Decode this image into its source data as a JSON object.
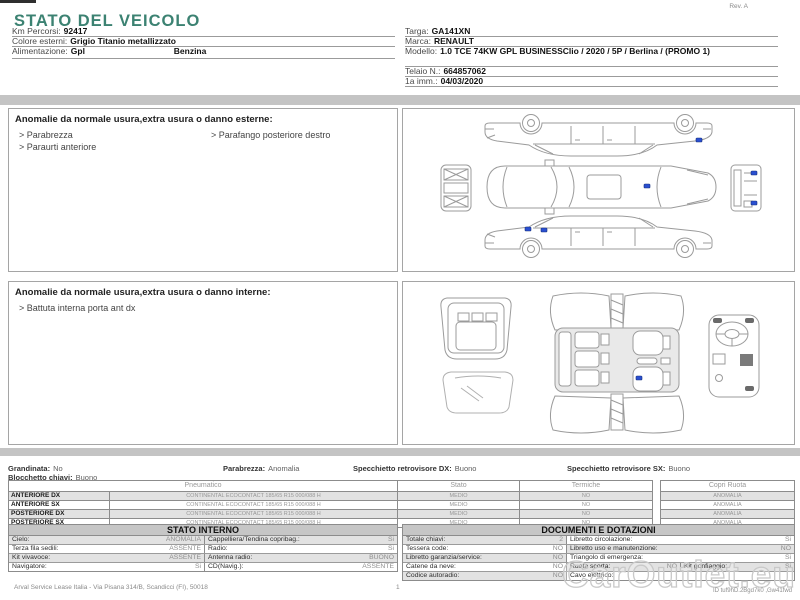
{
  "title": "STATO DEL VEICOLO",
  "rev": "Rev. A",
  "vehicle": {
    "km_label": "Km Percorsi:",
    "km": "92417",
    "color_label": "Colore esterni:",
    "color": "Grigio Titanio metallizzato",
    "fuel_label": "Alimentazione:",
    "fuel1": "Gpl",
    "fuel2": "Benzina",
    "plate_label": "Targa:",
    "plate": "GA141XN",
    "brand_label": "Marca:",
    "brand": "RENAULT",
    "model_label": "Modello:",
    "model": "1.0 TCE 74KW GPL BUSINESSClio / 2020 / 5P / Berlina / (PROMO 1)",
    "vin_label": "Telaio N.:",
    "vin": "664857062",
    "firstreg_label": "1a imm.:",
    "firstreg": "04/03/2020"
  },
  "exterior_anomalies": {
    "title": "Anomalie da normale usura,extra usura o danno esterne:",
    "col1": [
      "> Parabrezza",
      "> Paraurti anteriore"
    ],
    "col2": [
      "> Parafango posteriore destro"
    ]
  },
  "interior_anomalies": {
    "title": "Anomalie da normale usura,extra usura o danno interne:",
    "col1": [
      "> Battuta interna porta ant dx"
    ]
  },
  "checks": {
    "grandinata_label": "Grandinata:",
    "grandinata": "No",
    "parabrezza_label": "Parabrezza:",
    "parabrezza": "Anomalia",
    "mirror_dx_label": "Specchietto retrovisore DX:",
    "mirror_dx": "Buono",
    "mirror_sx_label": "Specchietto retrovisore SX:",
    "mirror_sx": "Buono",
    "key_block_label": "Blocchetto chiavi:",
    "key_block": "Buono"
  },
  "tires": {
    "col_pneumatico": "Pneumatico",
    "col_stato": "Stato",
    "col_termiche": "Termiche",
    "col_copri": "Copri Ruota",
    "rows": [
      {
        "pos": "ANTERIORE DX",
        "spec": "CONTINENTAL ECOCONTACT 185/65 R15 000/088 H",
        "stato": "MEDIO",
        "termiche": "NO",
        "copri": "ANOMALIA"
      },
      {
        "pos": "ANTERIORE SX",
        "spec": "CONTINENTAL ECOCONTACT 185/65 R15 000/088 H",
        "stato": "MEDIO",
        "termiche": "NO",
        "copri": "ANOMALIA"
      },
      {
        "pos": "POSTERIORE DX",
        "spec": "CONTINENTAL ECOCONTACT 185/65 R15 000/088 H",
        "stato": "MEDIO",
        "termiche": "NO",
        "copri": "ANOMALIA"
      },
      {
        "pos": "POSTERIORE SX",
        "spec": "CONTINENTAL ECOCONTACT 185/65 R15 000/088 H",
        "stato": "MEDIO",
        "termiche": "NO",
        "copri": "ANOMALIA"
      }
    ]
  },
  "stato_interno": {
    "title": "STATO INTERNO",
    "rows": [
      {
        "l1": "Cielo:",
        "v1": "ANOMALIA",
        "l2": "Cappelliera/Tendina copribag.:",
        "v2": "Si"
      },
      {
        "l1": "Terza fila sedili:",
        "v1": "ASSENTE",
        "l2": "Radio:",
        "v2": "Si"
      },
      {
        "l1": "Kit vivavoce:",
        "v1": "ASSENTE",
        "l2": "Antenna radio:",
        "v2": "BUONO"
      },
      {
        "l1": "Navigatore:",
        "v1": "Si",
        "l2": "CD(Navig.):",
        "v2": "ASSENTE"
      }
    ]
  },
  "documenti": {
    "title": "DOCUMENTI E DOTAZIONI",
    "rows": [
      {
        "l1": "Totale chiavi:",
        "v1": "2",
        "l2": "Libretto circolazione:",
        "v2": "Si"
      },
      {
        "l1": "Tessera code:",
        "v1": "NO",
        "l2": "Libretto uso e manutenzione:",
        "v2": "NO"
      },
      {
        "l1": "Libretto garanzia/service:",
        "v1": "NO",
        "l2": "Triangolo di emergenza:",
        "v2": "Si"
      },
      {
        "l1": "Catene da neve:",
        "v1": "NO",
        "l2": "Ruota scorta:",
        "v2": "NO",
        "l3": "Kit gonfiaggio:",
        "v3": "Si"
      },
      {
        "l1": "Codice autoradio:",
        "v1": "NO",
        "l2": "Cavo elettrico:",
        "v2": ""
      }
    ]
  },
  "footer": {
    "company": "Arval Service Lease Italia - Via Pisana 314/B, Scandicci (FI), 50018",
    "page": "1",
    "doc_id": "ID tuf9hD.2Bgd7k0 ,Gw41fwd"
  },
  "watermark": "CarOutlet.eu",
  "colors": {
    "accent_teal": "#3c8272",
    "marker_blue": "#2a4fd0",
    "row_gray": "#e2e2e2",
    "header_gray": "#c6c6c6",
    "bar_gray": "#c4c4c4"
  }
}
